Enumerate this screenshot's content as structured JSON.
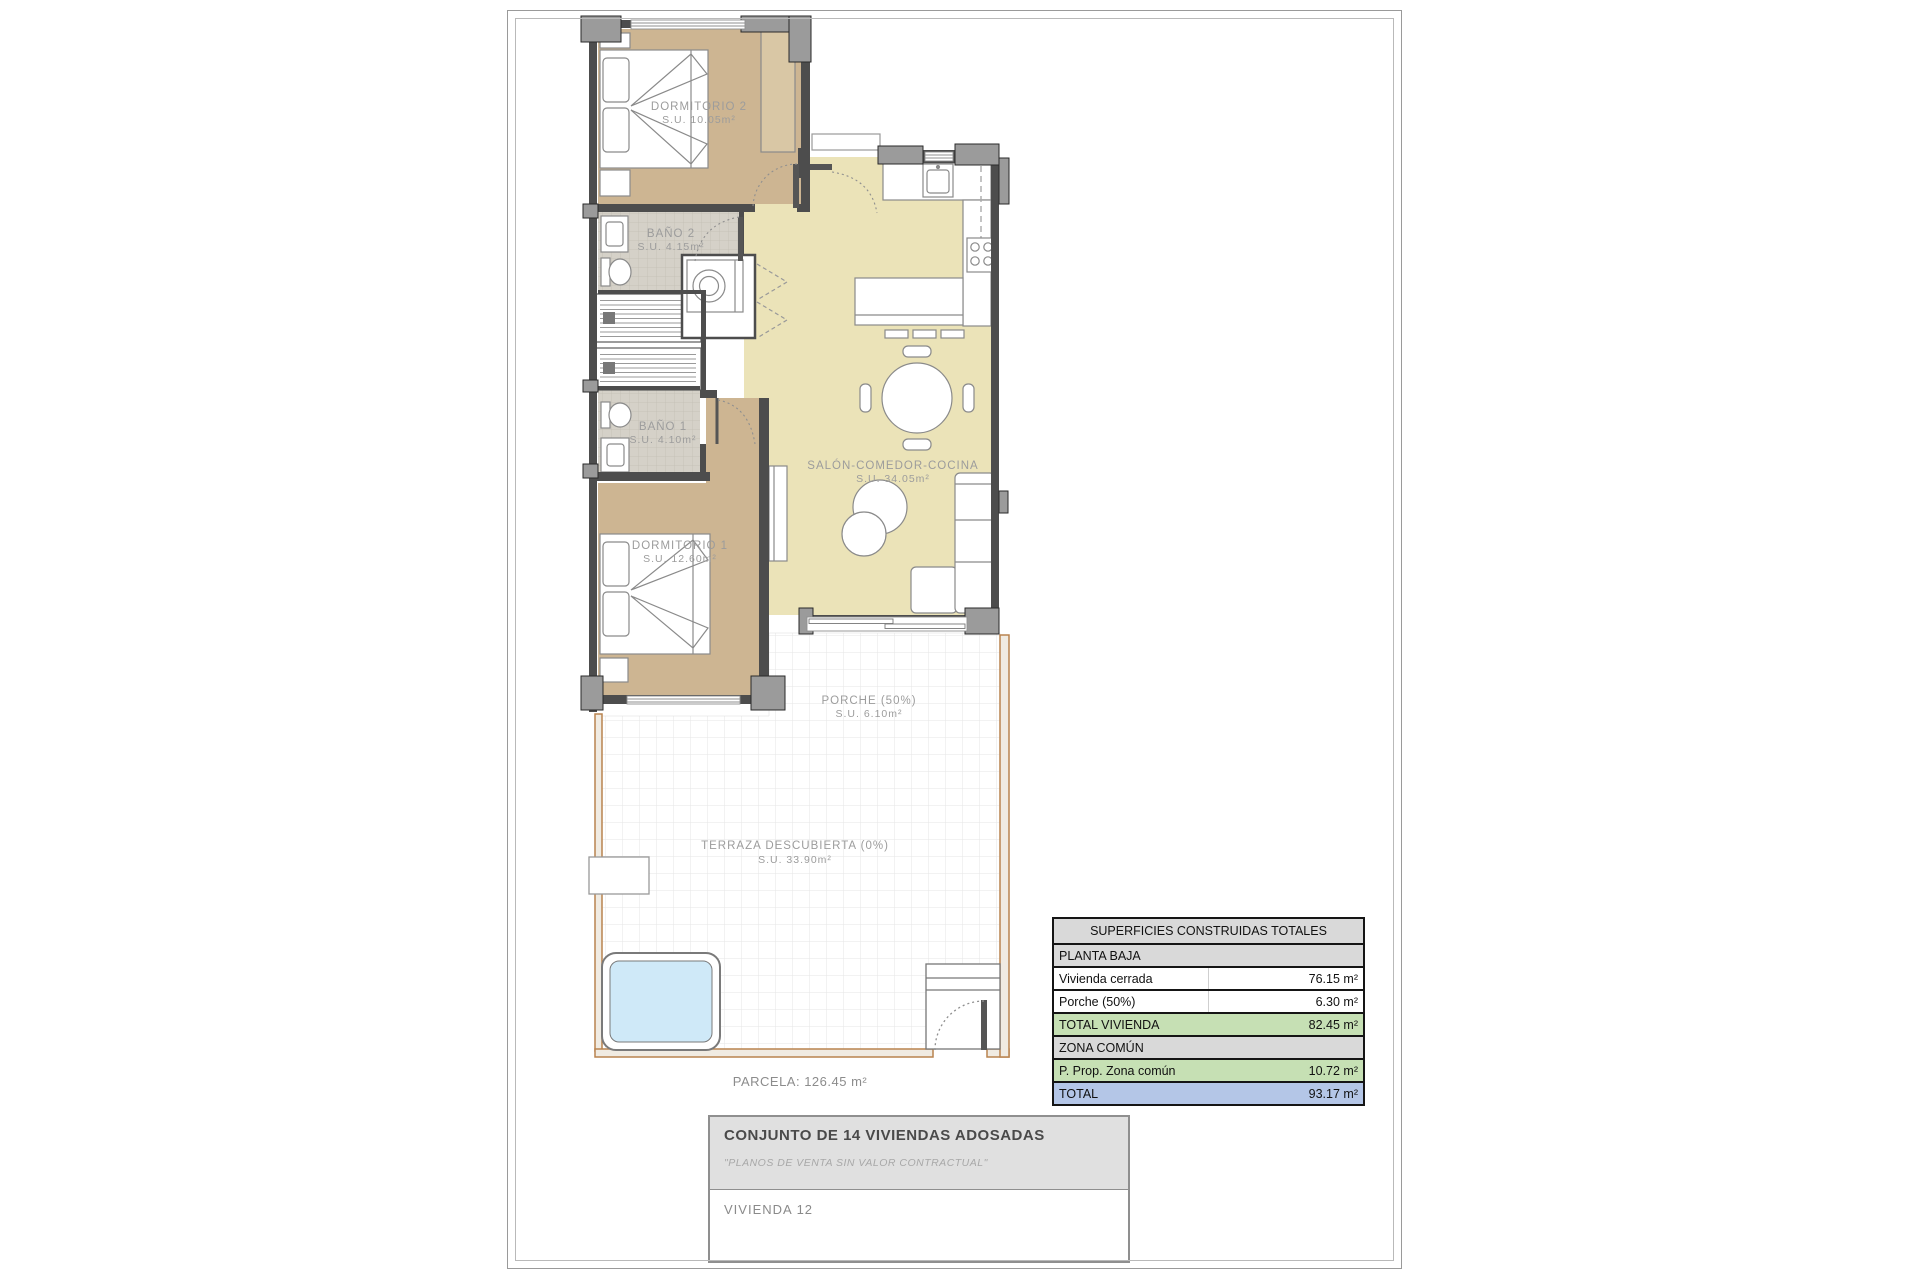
{
  "rooms": {
    "dormitorio2": {
      "name": "DORMITORIO 2",
      "area": "S.U. 10.05m²"
    },
    "bano2": {
      "name": "BAÑO 2",
      "area": "S.U. 4.15m²"
    },
    "bano1": {
      "name": "BAÑO 1",
      "area": "S.U. 4.10m²"
    },
    "dormitorio1": {
      "name": "DORMITORIO 1",
      "area": "S.U. 12.60m²"
    },
    "salon": {
      "name": "SALÓN-COMEDOR-COCINA",
      "area": "S.U. 34.05m²"
    },
    "porche": {
      "name": "PORCHE (50%)",
      "area": "S.U. 6.10m²"
    },
    "terraza": {
      "name": "TERRAZA DESCUBIERTA (0%)",
      "area": "S.U. 33.90m²"
    }
  },
  "parcela_label": "PARCELA: 126.45 m²",
  "areas_table": {
    "title": "SUPERFICIES CONSTRUIDAS TOTALES",
    "rows": [
      {
        "label": "PLANTA BAJA",
        "value": "",
        "style": "section"
      },
      {
        "label": "Vivienda cerrada",
        "value": "76.15 m²",
        "style": "plain"
      },
      {
        "label": "Porche (50%)",
        "value": "6.30 m²",
        "style": "plain"
      },
      {
        "label": "TOTAL VIVIENDA",
        "value": "82.45 m²",
        "style": "subtotal"
      },
      {
        "label": "ZONA COMÚN",
        "value": "",
        "style": "section"
      },
      {
        "label": "P. Prop. Zona común",
        "value": "10.72 m²",
        "style": "subtotal"
      },
      {
        "label": "TOTAL",
        "value": "93.17 m²",
        "style": "total"
      }
    ]
  },
  "title_block": {
    "project": "CONJUNTO DE 14 VIVIENDAS ADOSADAS",
    "disclaimer": "\"PLANOS DE VENTA SIN VALOR CONTRACTUAL\"",
    "unit": "VIVIENDA 12"
  },
  "colors": {
    "wall": "#4d4d4d",
    "pillar": "#9b9b9b",
    "bedroom_floor": "#cdb592",
    "salon_floor": "#ebe3b8",
    "bath_tile": "#d5d1c8",
    "pool_water": "#cfe9f8",
    "parcela_wall_line": "#b9834f",
    "table_section_bg": "#d9d9d9",
    "table_subtotal_bg": "#c6e0b4",
    "table_total_bg": "#b4c6e7",
    "label_text": "#9c9c9c"
  }
}
